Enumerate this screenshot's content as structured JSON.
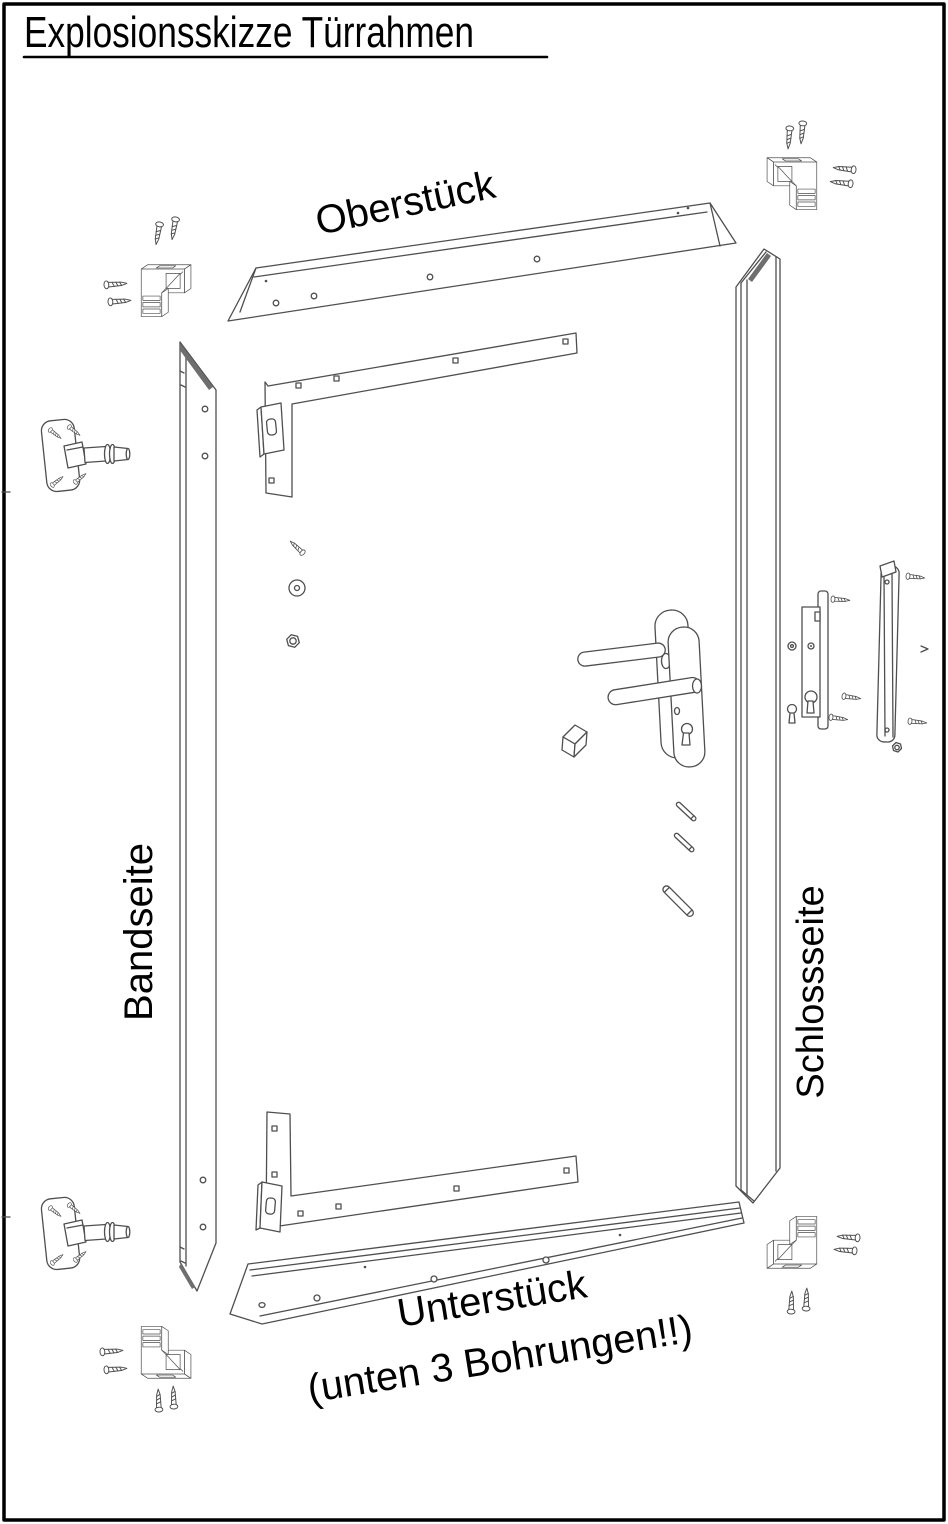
{
  "title": "Explosionsskizze Türrahmen",
  "diagram": {
    "labels": {
      "top_piece": "Oberstück",
      "hinge_side": "Bandseite",
      "lock_side": "Schlossseite",
      "bottom_piece": "Unterstück",
      "bottom_note": "(unten 3 Bohrungen!!)"
    },
    "colors": {
      "background": "#ffffff",
      "border": "#000000",
      "line": "#4f4f4f",
      "label_text": "#000000"
    },
    "part_names": [
      "top-piece-panel",
      "bottom-piece-panel",
      "hinge-side-rail",
      "lock-side-rail",
      "top-angle-bracket",
      "bottom-angle-bracket",
      "corner-connector (x4)",
      "hinge (x2)",
      "door-handle-set",
      "mortise-lock",
      "strike-plate",
      "screw (many)",
      "dowel-pins",
      "washer",
      "hex-nut",
      "bolt",
      "spindle-block"
    ]
  }
}
